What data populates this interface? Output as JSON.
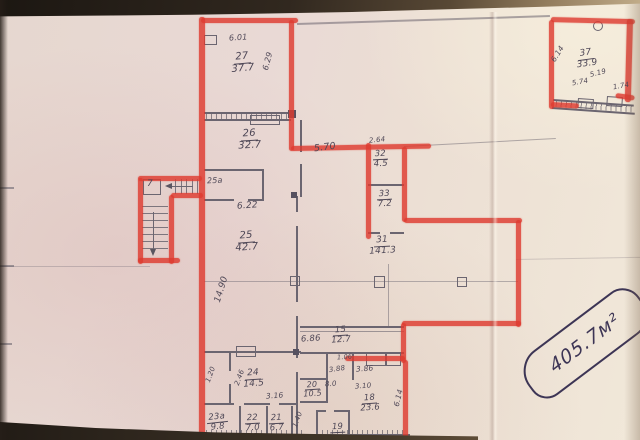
{
  "document_kind": "scanned building floor plan with red marker highlights",
  "colors": {
    "marker_red": "#de3b2f",
    "pen_blue": "#3d3555",
    "pencil_grey": "#4e4756"
  },
  "note_badge": {
    "text": "405.7м²"
  },
  "rooms": [
    {
      "number": "27",
      "area": "37.7"
    },
    {
      "number": "26",
      "area": "32.7"
    },
    {
      "number": "25а",
      "area": ""
    },
    {
      "number": "25",
      "area": "42.7"
    },
    {
      "number": "32",
      "area": "4.5"
    },
    {
      "number": "33",
      "area": "7.2"
    },
    {
      "number": "31",
      "area": "141.3"
    },
    {
      "number": "15",
      "area": "12.7"
    },
    {
      "number": "24",
      "area": "14.5"
    },
    {
      "number": "23а",
      "area": "9.8"
    },
    {
      "number": "22",
      "area": "7.0"
    },
    {
      "number": "21",
      "area": "6.7"
    },
    {
      "number": "20",
      "area": "10.5"
    },
    {
      "number": "19",
      "area": ""
    },
    {
      "number": "18",
      "area": "23.6"
    },
    {
      "number": "37",
      "area": "33.9"
    },
    {
      "number": "7",
      "area": ""
    }
  ],
  "dimensions": [
    {
      "v": "6.01"
    },
    {
      "v": "6.29"
    },
    {
      "v": "6.22"
    },
    {
      "v": "5.70"
    },
    {
      "v": "2.64"
    },
    {
      "v": "14.90"
    },
    {
      "v": "6.86"
    },
    {
      "v": "3.86"
    },
    {
      "v": "3.88"
    },
    {
      "v": "1.06"
    },
    {
      "v": "8.0"
    },
    {
      "v": "3.10"
    },
    {
      "v": "3.16"
    },
    {
      "v": "1.20"
    },
    {
      "v": "2.46"
    },
    {
      "v": "1.40"
    },
    {
      "v": "6.14"
    },
    {
      "v": "6.14"
    },
    {
      "v": "5.74"
    },
    {
      "v": "5.19"
    },
    {
      "v": "1.74"
    }
  ]
}
